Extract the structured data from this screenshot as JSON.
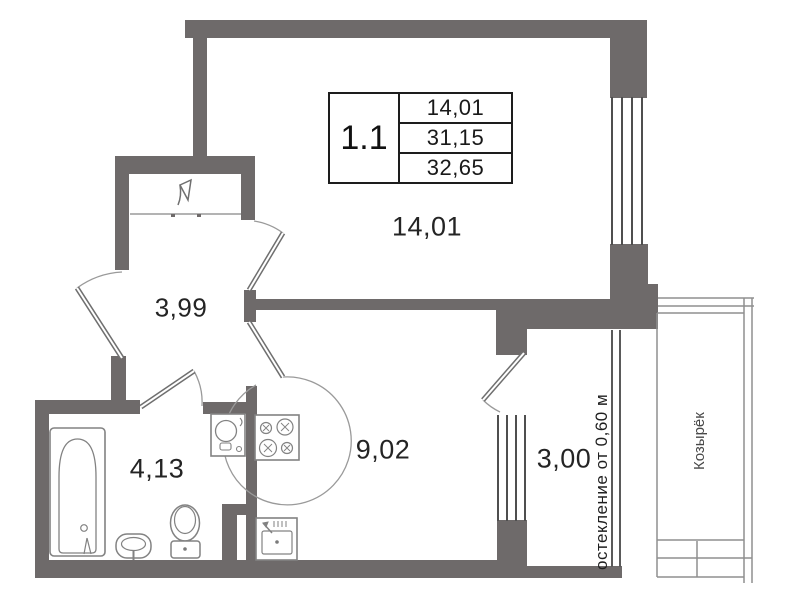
{
  "title_block": {
    "unit": "1.1",
    "rows": [
      "14,01",
      "31,15",
      "32,65"
    ]
  },
  "rooms": {
    "living": {
      "area": "14,01"
    },
    "hallway": {
      "area": "3,99"
    },
    "bathroom": {
      "area": "4,13"
    },
    "kitchen": {
      "area": "9,02"
    },
    "balcony": {
      "area": "3,00"
    }
  },
  "annotations": {
    "glazing_note": "остекление от 0,60 м",
    "canopy_label": "Козырёк"
  },
  "colors": {
    "wall": "#6e6a6a",
    "thin_line": "#5a5a5a",
    "fixture_line": "#828282",
    "text": "#1f1f1f"
  }
}
